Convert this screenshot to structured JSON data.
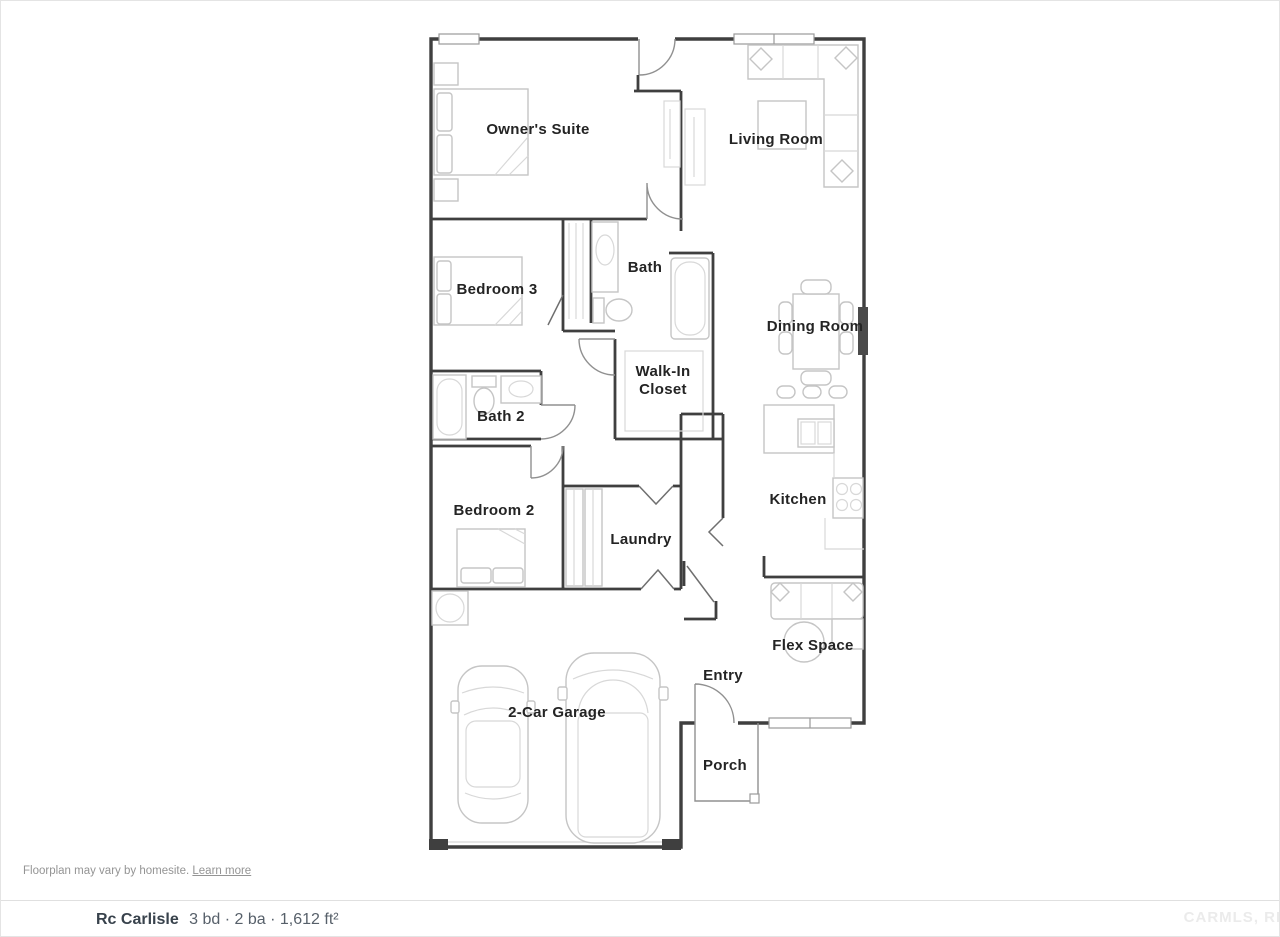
{
  "floorplan": {
    "rooms": [
      {
        "id": "owners-suite",
        "label": "Owner's Suite"
      },
      {
        "id": "living-room",
        "label": "Living Room"
      },
      {
        "id": "bath",
        "label": "Bath"
      },
      {
        "id": "bedroom-3",
        "label": "Bedroom 3"
      },
      {
        "id": "dining-room",
        "label": "Dining Room"
      },
      {
        "id": "walk-in-closet",
        "label": "Walk-In Closet",
        "label_line1": "Walk-In",
        "label_line2": "Closet"
      },
      {
        "id": "bath-2",
        "label": "Bath 2"
      },
      {
        "id": "kitchen",
        "label": "Kitchen"
      },
      {
        "id": "bedroom-2",
        "label": "Bedroom 2"
      },
      {
        "id": "laundry",
        "label": "Laundry"
      },
      {
        "id": "flex-space",
        "label": "Flex Space"
      },
      {
        "id": "entry",
        "label": "Entry"
      },
      {
        "id": "garage",
        "label": "2-Car Garage"
      },
      {
        "id": "porch",
        "label": "Porch"
      }
    ],
    "disclaimer": {
      "text": "Floorplan may vary by homesite.",
      "link_label": "Learn more"
    }
  },
  "plan_bar": {
    "name": "Rc Carlisle",
    "details": "3 bd · 2 ba · 1,612 ft²",
    "beds": "3 bd",
    "baths": "2 ba",
    "area": "1,612 ft²"
  },
  "watermark": {
    "text": "CARMLS, RE"
  },
  "colors": {
    "wall": "#3f3f3f",
    "furniture_line": "#c5c5c5",
    "label_text": "#242424",
    "disclaimer_gray": "#949494",
    "bar_name": "#38424c",
    "bar_details": "#57606a",
    "divider": "#e0e0e0",
    "watermark": "#ebebeb"
  }
}
